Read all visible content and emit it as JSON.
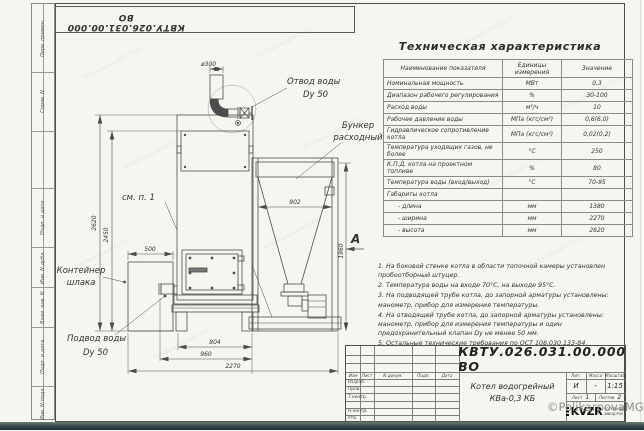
{
  "page": {
    "doc_number_top": "КВТУ.026.031.00.000 ВО"
  },
  "margin_labels": [
    "Перв. примен.",
    "Справ. N",
    "",
    "Подп. и дата",
    "Инв. N дубл.",
    "Взам. инв. N",
    "Подп. и дата",
    "Инв. N подл."
  ],
  "drawing": {
    "dims": {
      "d300": "ø300",
      "h2620": "2620",
      "h2450": "2450",
      "w500": "500",
      "w902": "902",
      "h1960": "1960",
      "w804": "804",
      "w960": "960",
      "w2270": "2270"
    },
    "labels": {
      "outlet_line1": "Отвод воды",
      "outlet_line2": "Dy 50",
      "bunker_line1": "Бункер",
      "bunker_line2": "расходный",
      "see_note": "см. п. 1",
      "container_line1": "Контейнер",
      "container_line2": "шлака",
      "inlet_line1": "Подвод воды",
      "inlet_line2": "Dy 50",
      "view_arrow": "А"
    }
  },
  "spec_table": {
    "title": "Техническая характеристика",
    "col_name": "Наименование показателя",
    "col_units": "Единицы измерения",
    "col_value": "Значение",
    "rows": [
      {
        "name": "Номинальная мощность",
        "units": "МВт",
        "value": "0,3"
      },
      {
        "name": "Диапазон рабочего регулирования",
        "units": "%",
        "value": "30-100"
      },
      {
        "name": "Расход воды",
        "units": "м³/ч",
        "value": "10"
      },
      {
        "name": "Рабочее давление воды",
        "units": "МПа (кгс/см²)",
        "value": "0,6(6,0)"
      },
      {
        "name": "Гидравлическое сопротивление котла",
        "units": "МПа (кгс/см²)",
        "value": "0,02(0,2)"
      },
      {
        "name": "Температура уходящих газов, не более",
        "units": "°С",
        "value": "250"
      },
      {
        "name": "К.П.Д. котла на проектном топливе",
        "units": "%",
        "value": "80"
      },
      {
        "name": "Температура воды (вход/выход)",
        "units": "°С",
        "value": "70-95"
      },
      {
        "name": "Габариты котла",
        "units": "",
        "value": ""
      },
      {
        "name": "- длина",
        "units": "мм",
        "value": "1380"
      },
      {
        "name": "- ширина",
        "units": "мм",
        "value": "2270"
      },
      {
        "name": "- высота",
        "units": "мм",
        "value": "2620"
      }
    ]
  },
  "notes": [
    "1. На боковой стенке котла в области топочной камеры установлен пробоотборный штуцер.",
    "2. Температура воды на входе 70°С, на выходе 95°С.",
    "3. На подводящей трубе котла, до запорной арматуры установлены: манометр, прибор для измерения температуры.",
    "4. На отводящей трубе котла, до запорной арматуры установлены: манометр, прибор для измерения температуры и один предохранительный клапан Dy не менее 50 мм.",
    "5. Остальные технические требования по ОСТ 108.030.133-84."
  ],
  "title_block": {
    "doc_number": "КВТУ.026.031.00.000 ВО",
    "rev_headers": [
      "Изм",
      "Лист",
      "N докум.",
      "Подп.",
      "Дата"
    ],
    "roles": [
      "Разраб.",
      "Пров.",
      "Т.контр.",
      "",
      "Н.контр.",
      "Утв."
    ],
    "product_line1": "Котел водогрейный",
    "product_line2": "КВа-0,3 КБ",
    "lit_label": "Лит.",
    "mass_label": "Масса",
    "scale_label": "Масштаб",
    "lit_value": "И",
    "mass_value": "-",
    "scale_value": "1:15",
    "sheet_label": "Лист",
    "sheet_value": "1",
    "sheets_label": "Листов",
    "sheets_value": "2",
    "logo_text": "KVZR",
    "logo_sub1": "КОТЕЛЬНЫЙ",
    "logo_sub2": "ЗАВОД РЭП"
  },
  "watermark": {
    "main": "©PolikarpovaMG2021",
    "tile_text": "©PolikarpovaMG2021"
  }
}
